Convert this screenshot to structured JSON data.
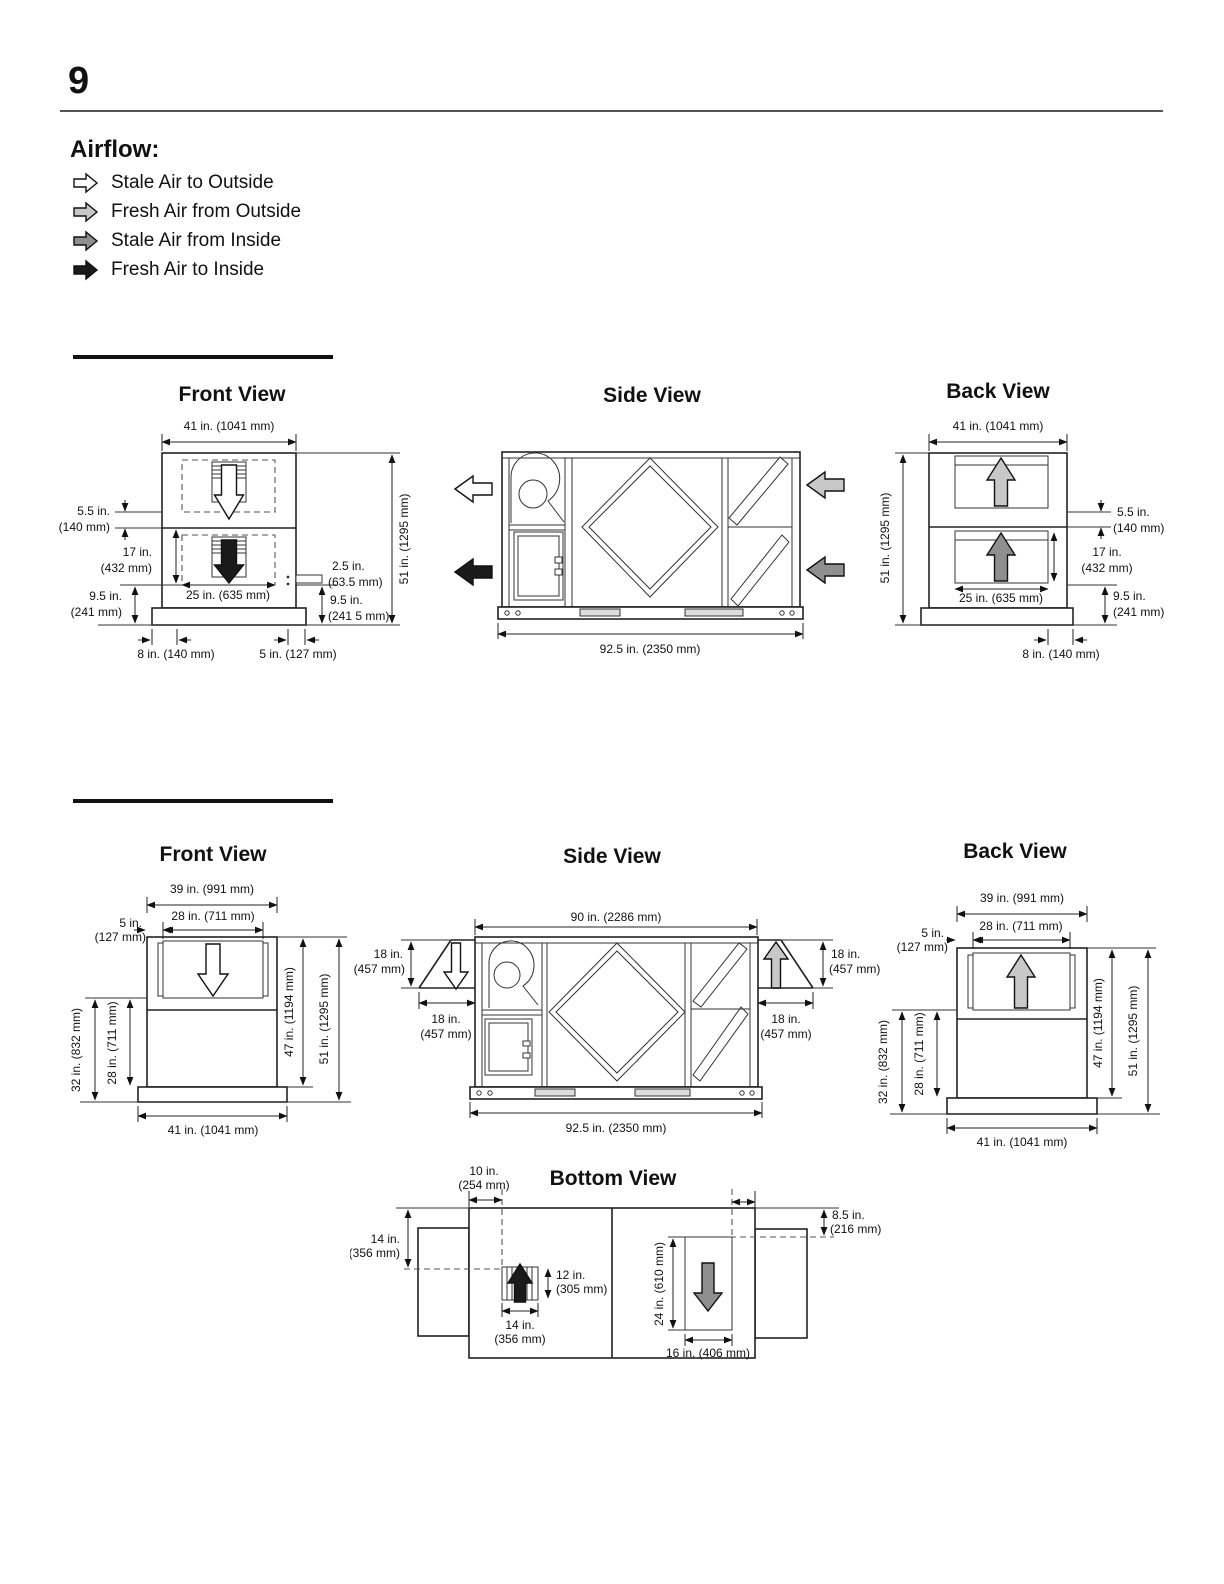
{
  "page": {
    "number": "9"
  },
  "airflow": {
    "heading": "Airflow:",
    "items": [
      {
        "label": "Stale Air to Outside",
        "color": "#ffffff"
      },
      {
        "label": "Fresh Air from Outside",
        "color": "#c8c8c8"
      },
      {
        "label": "Stale Air from Inside",
        "color": "#8f8f8f"
      },
      {
        "label": "Fresh Air to Inside",
        "color": "#1a1a1a"
      }
    ]
  },
  "unit1": {
    "front": {
      "title": "Front View",
      "width_top": "41 in. (1041 mm)",
      "gap_in": "5.5 in.",
      "gap_mm": "(140 mm)",
      "opening_h_in": "17 in.",
      "opening_h_mm": "(432 mm)",
      "base_off_in": "9.5 in.",
      "base_off_mm": "(241 mm)",
      "opening_w": "25 in. (635 mm)",
      "drain_in": "2.5 in.",
      "drain_mm": "(63.5 mm)",
      "right_off_in": "9.5 in.",
      "right_off_mm": "(241 5 mm)",
      "height": "51 in. (1295 mm)",
      "foot_left": "8 in. (140 mm)",
      "foot_right": "5 in. (127 mm)"
    },
    "side": {
      "title": "Side View",
      "length": "92.5 in. (2350 mm)"
    },
    "back": {
      "title": "Back View",
      "width_top": "41 in. (1041 mm)",
      "height": "51 in. (1295 mm)",
      "opening_w": "25 in. (635 mm)",
      "gap_in": "5.5 in.",
      "gap_mm": "(140 mm)",
      "opening_h_in": "17 in.",
      "opening_h_mm": "(432 mm)",
      "base_off_in": "9.5 in.",
      "base_off_mm": "(241 mm)",
      "foot": "8 in. (140 mm)"
    }
  },
  "unit2": {
    "front": {
      "title": "Front View",
      "width_top": "39 in. (991 mm)",
      "opening_w": "28 in. (711 mm)",
      "offset_in": "5 in.",
      "offset_mm": "(127 mm)",
      "height_ground": "32 in. (832 mm)",
      "height_base": "28 in. (711 mm)",
      "height_cabinet": "47 in. (1194 mm)",
      "height_total": "51 in. (1295 mm)",
      "width_base": "41 in. (1041 mm)"
    },
    "side": {
      "title": "Side View",
      "length_top": "90 in. (2286 mm)",
      "length_base": "92.5 in. (2350 mm)",
      "hood_left_h_in": "18 in.",
      "hood_left_h_mm": "(457 mm)",
      "hood_left_w_in": "18 in.",
      "hood_left_w_mm": "(457 mm)",
      "hood_right_h_in": "18 in.",
      "hood_right_h_mm": "(457 mm)",
      "hood_right_w_in": "18 in.",
      "hood_right_w_mm": "(457 mm)"
    },
    "back": {
      "title": "Back View",
      "width_top": "39 in. (991 mm)",
      "opening_w": "28 in. (711 mm)",
      "offset_in": "5 in.",
      "offset_mm": "(127 mm)",
      "height_ground": "32 in. (832 mm)",
      "height_base": "28 in. (711 mm)",
      "height_cabinet": "47 in. (1194 mm)",
      "height_total": "51 in. (1295 mm)",
      "width_base": "41 in. (1041 mm)"
    }
  },
  "bottom": {
    "title": "Bottom View",
    "offset_in": "10 in.",
    "offset_mm": "(254 mm)",
    "side_in": "14 in.",
    "side_mm": "(356 mm)",
    "grille_h_in": "12 in.",
    "grille_h_mm": "(305 mm)",
    "grille_w_in": "14 in.",
    "grille_w_mm": "(356 mm)",
    "opening_h": "24 in. (610 mm)",
    "opening_w": "16 in. (406 mm)",
    "edge_in": "8.5 in.",
    "edge_mm": "(216 mm)"
  }
}
